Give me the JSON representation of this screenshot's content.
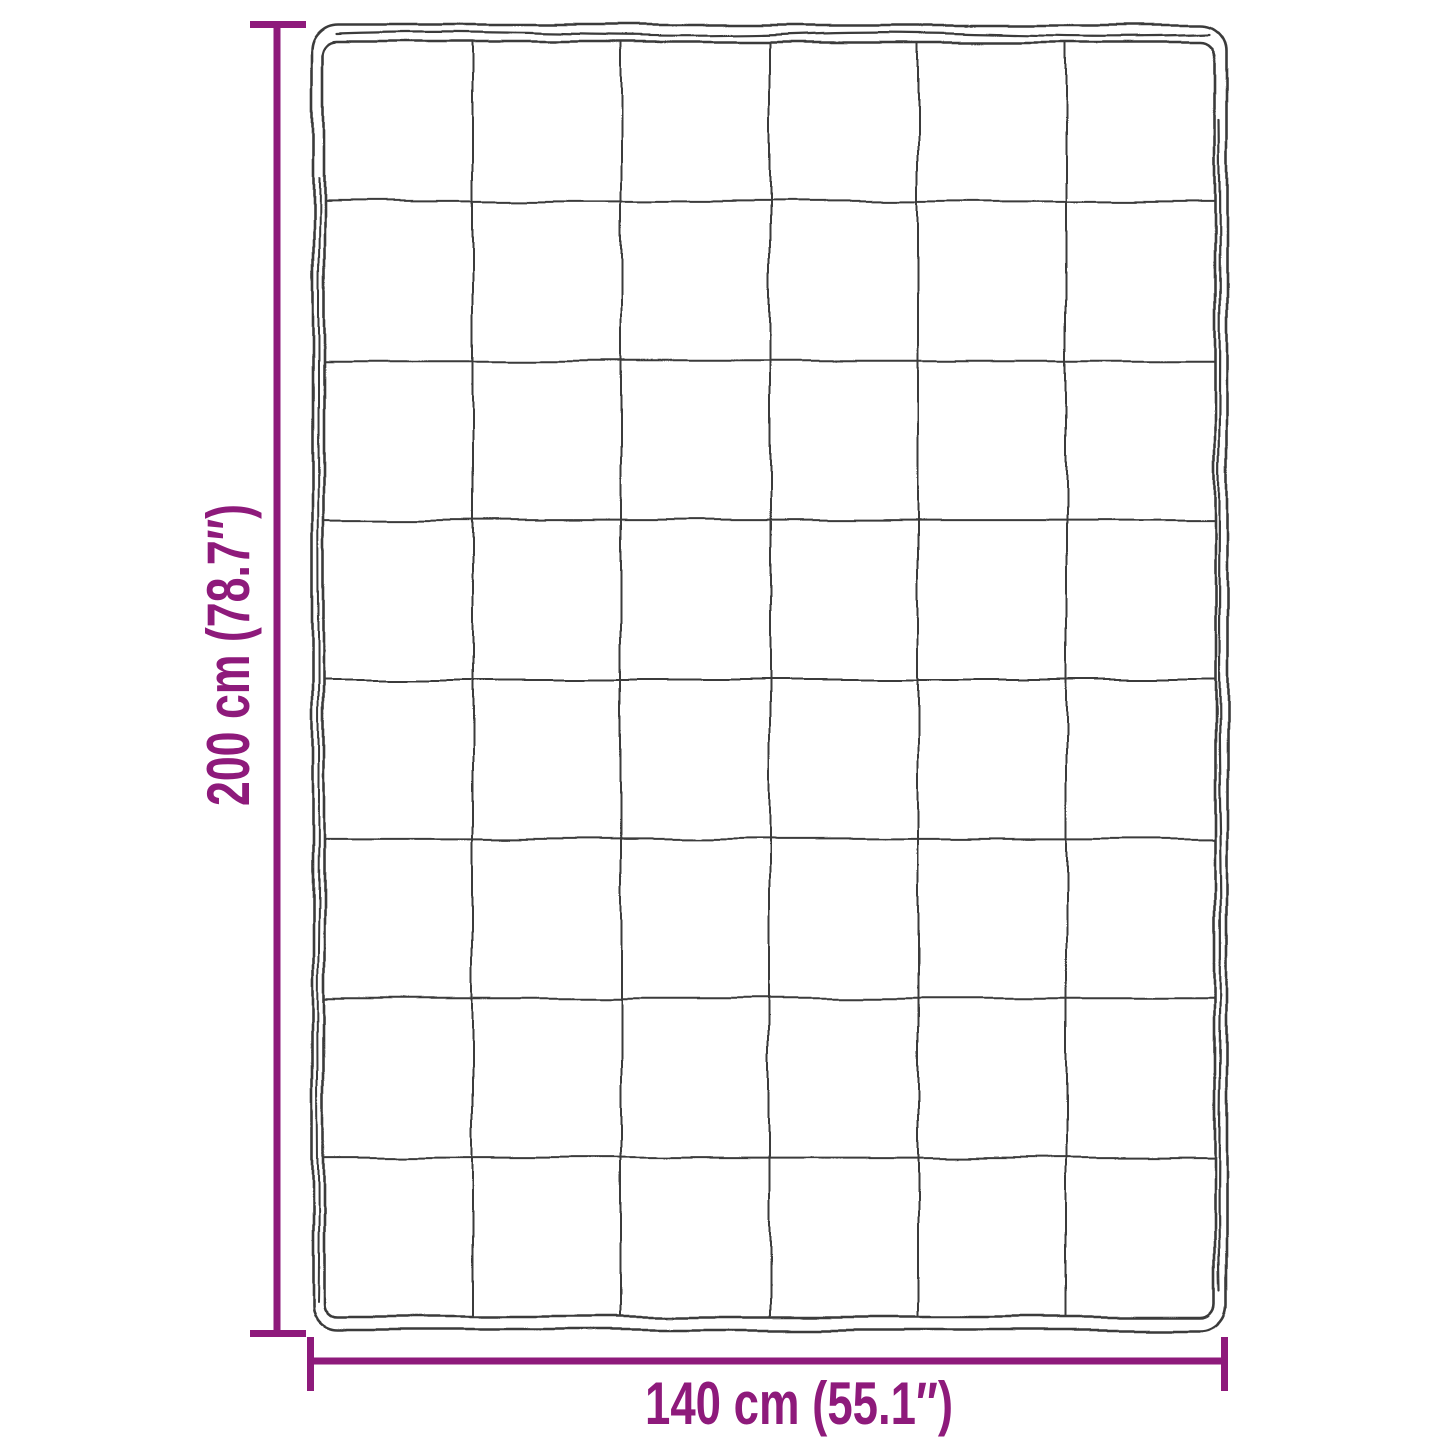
{
  "diagram": {
    "title": "blanket dimension diagram",
    "height_label": "200 cm (78.7″)",
    "width_label": "140 cm (55.1″)",
    "grid": {
      "columns": 6,
      "rows": 8
    },
    "colors": {
      "dimension": "#8E1A7B",
      "outline": "#3B3B3B",
      "background": "#FFFFFF"
    }
  }
}
